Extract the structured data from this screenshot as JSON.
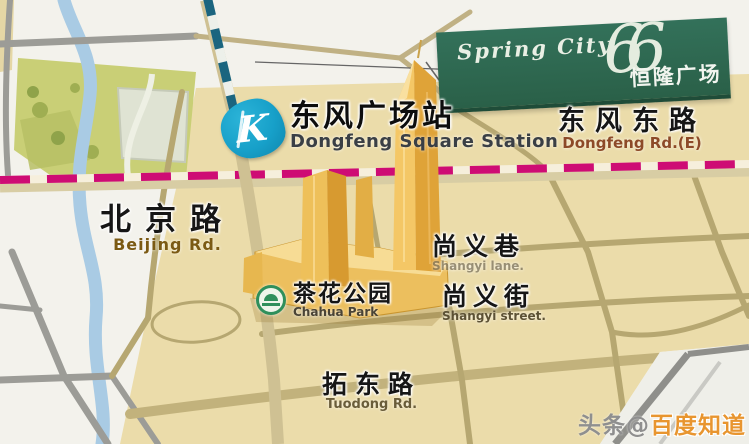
{
  "banner": {
    "script_title": "Spring City",
    "logo_numerals": "66",
    "title_cjk": "恒隆广场"
  },
  "station": {
    "logo_letter": "K",
    "name_cjk": "东风广场站",
    "name_en": "Dongfeng Square Station"
  },
  "labels": {
    "dongfeng_rd": {
      "cjk": "东风东路",
      "en": "Dongfeng Rd.(E)"
    },
    "beijing_rd": {
      "cjk": "北京路",
      "en": "Beijing Rd."
    },
    "shangyi_lane": {
      "cjk": "尚义巷",
      "en": "Shangyi lane."
    },
    "shangyi_street": {
      "cjk": "尚义街",
      "en": "Shangyi street."
    },
    "chahua_park": {
      "cjk": "茶花公园",
      "en": "Chahua Park"
    },
    "tuodong_rd": {
      "cjk": "拓东路",
      "en": "Tuodong Rd."
    }
  },
  "watermark": {
    "prefix": "头条@",
    "brand": "百度知道"
  },
  "colors": {
    "banner_green": "#2e6950",
    "metro_logo_blue": "#17a0c9",
    "metro_line_east_west": "#ce0c74",
    "metro_line_north_south": "#1b657f",
    "map_beige": "#ebdcaa",
    "building_gold": "#e8b34a",
    "park_green": "#c9cf76",
    "river_blue": "#a9cbe4",
    "watermark_orange": "#e8952f"
  }
}
